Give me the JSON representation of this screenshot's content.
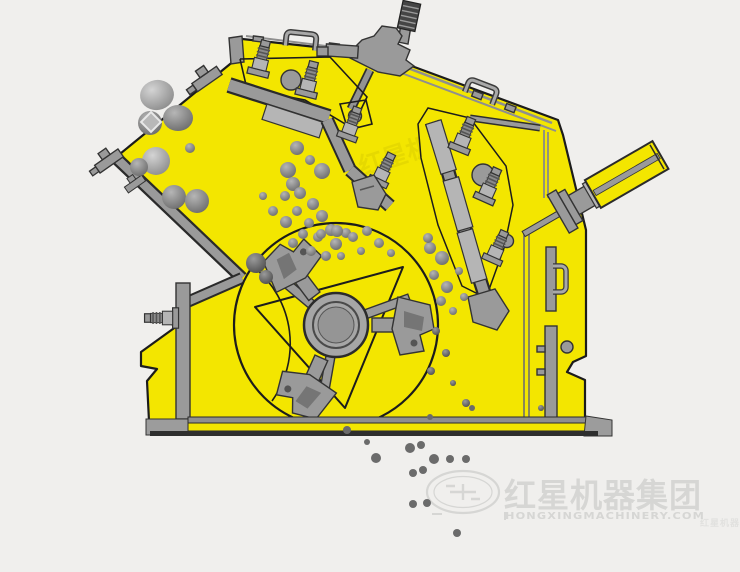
{
  "diagram": {
    "subject": "impact-crusher-cutaway-working-principle"
  },
  "watermark": {
    "brand_cn": "红星机器集团",
    "brand_en": "HONGXINGMACHINERY.COM"
  },
  "inner_watermark": {
    "text_cn": "红星机器"
  },
  "corner_watermark": {
    "text_cn": "红星机器"
  },
  "colors": {
    "background": "#f0efed",
    "body_yellow": "#f3e600",
    "body_yellow_dark": "#d9c900",
    "part_gray": "#9a9a9a",
    "part_gray_light": "#b5b5b5",
    "part_gray_dark": "#6f6f6f",
    "outline": "#222222",
    "rock_gray": "#8a8a8a",
    "particle_gray": "#6b6b6b",
    "watermark_gray": "#d6d6d4"
  }
}
